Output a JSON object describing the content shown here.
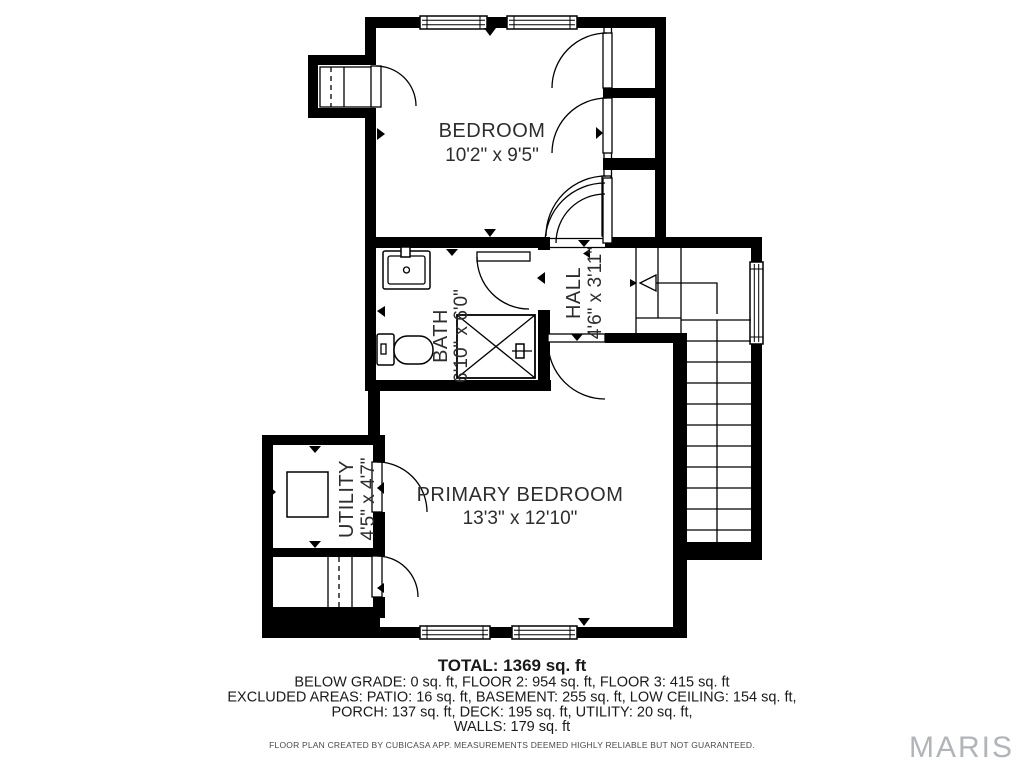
{
  "plan": {
    "rooms": [
      {
        "id": "bedroom",
        "label": "BEDROOM",
        "dims": "10'2\" x 9'5\""
      },
      {
        "id": "bath",
        "label": "BATH",
        "dims": "6'10\" x 6'0\""
      },
      {
        "id": "hall",
        "label": "HALL",
        "dims": "4'6\" x 3'11\""
      },
      {
        "id": "primary_bedroom",
        "label": "PRIMARY BEDROOM",
        "dims": "13'3\" x 12'10\""
      },
      {
        "id": "utility",
        "label": "UTILITY",
        "dims": "4'5\" x 4'7\""
      }
    ]
  },
  "footer": {
    "total": "TOTAL: 1369 sq. ft",
    "levels": "BELOW GRADE: 0 sq. ft, FLOOR 2: 954 sq. ft, FLOOR 3: 415 sq. ft",
    "excluded1": "EXCLUDED AREAS: PATIO: 16 sq. ft, BASEMENT: 255 sq. ft, LOW CEILING: 154 sq. ft,",
    "excluded2": "PORCH: 137 sq. ft, DECK: 195 sq. ft, UTILITY: 20 sq. ft,",
    "excluded3": "WALLS: 179 sq. ft",
    "attribution": "FLOOR PLAN CREATED BY CUBICASA APP. MEASUREMENTS DEEMED HIGHLY RELIABLE BUT NOT GUARANTEED."
  },
  "branding": {
    "logo": "MARIS"
  },
  "colors": {
    "walls": "#000000",
    "background": "#ffffff",
    "label_text": "#2d2d2d",
    "footer_text": "#1a1a1a",
    "logo_gray": "#b1b4b8"
  }
}
